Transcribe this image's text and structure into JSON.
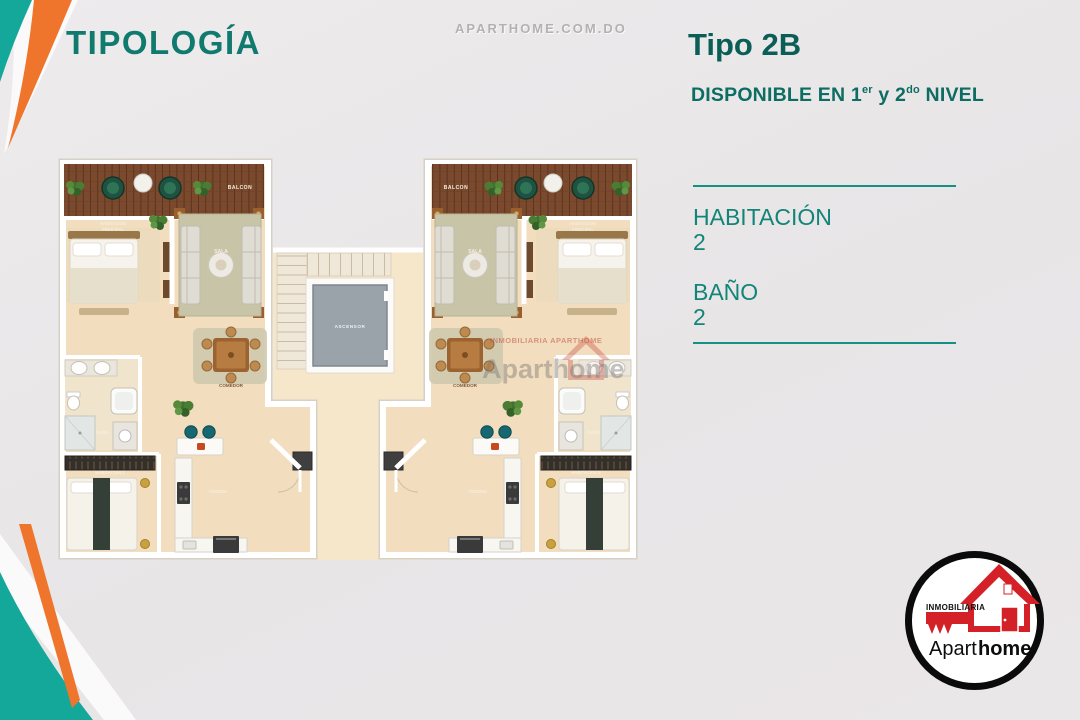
{
  "page": {
    "title": "TIPOLOGÍA",
    "top_watermark": "APARTHOME.COM.DO",
    "background": "#e9e6e8"
  },
  "header": {
    "type_name": "Tipo 2B",
    "availability": {
      "pre": "DISPONIBLE EN 1",
      "sup1": "er",
      "mid": " y 2",
      "sup2": "do",
      "post": " NIVEL"
    }
  },
  "specs": {
    "items": [
      {
        "label": "HABITACIÓN",
        "value": "2"
      },
      {
        "label": "BAÑO",
        "value": "2"
      }
    ]
  },
  "floorplan": {
    "labels": {
      "balcon": "BALCON",
      "hab_principal_1": "HABITACION",
      "hab_principal_2": "PRINCIPAL",
      "sala": "SALA",
      "comedor": "COMEDOR",
      "cocina": "COCINA",
      "bano": "BAÑO",
      "habitacion2": "HABITACION 2",
      "ascensor": "ASCENSOR"
    },
    "watermark": {
      "line1": "INMOBILIARIA APARTHOME",
      "line2": "Aparthome"
    }
  },
  "logo": {
    "tagline": "INMOBILIARIA",
    "name_regular": "Apart",
    "name_bold": "home"
  },
  "colors": {
    "teal_title": "#117a6e",
    "teal_dark": "#0a5e55",
    "teal_line": "#149084",
    "accent_orange": "#ee752b",
    "accent_turquoise": "#13a89a",
    "logo_red": "#d42127",
    "floor_cream": "#f2debf",
    "deck_wood": "#7b4a2e"
  }
}
